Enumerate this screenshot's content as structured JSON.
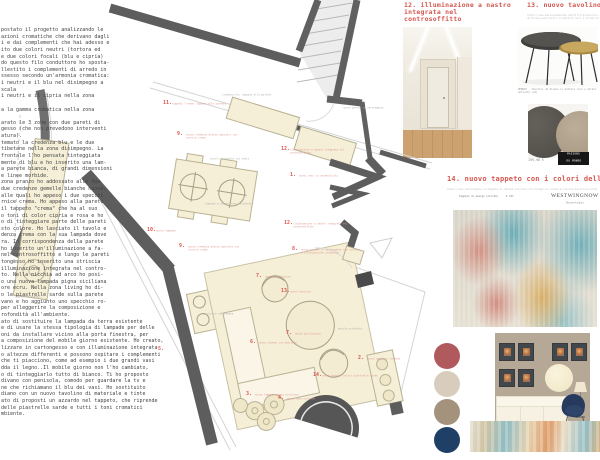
{
  "left_text": {
    "lines": [
      "postato il progetto analizzando le",
      "azioni cromatiche che derivano dagli",
      "i e dai complementi che hai adesso e",
      "ito due colori neutri (tortora ed",
      "e due colori focali (blu e cipria)",
      "do questo filo conduttore ho sposta-",
      "llestito i complementi di arredo in",
      "ssesso secondo un'armonia cromatica:",
      "i neutri e il blu nel disimpegno a",
      "scala",
      "i neutri e il cipria nella zona",
      "",
      "a la gamma cromatica nella zona",
      "",
      "arato le 3 zone con due pareti di",
      "gesso (che non prevedono interventi",
      "atura).",
      "temato la credenza blu e le due",
      "tibetane nella zona disimpegno. La",
      "frontale l'ho pensata tinteggiata",
      "mente di blu e ho inserito una lam-",
      "a parete bianca, di grandi dimensioni",
      "e linee morbide.",
      "zona pranzo ho addossato alle due",
      "due credenze gemelle bianche nuove,",
      "alle quali ho appeso i due specchi",
      "rnice crema. Ho appeso alla parete",
      "il tappeto \"crema\" che ha al suo",
      "o toni di color cipria e rosa e ho",
      "o di tinteggiare parte delle pareti",
      "sto colore. Ho lasciato il tavolo e",
      "denza crema con la sua lampada dove",
      "ra. In corrispondenza della parete",
      "ho inserito un'illuminazione a fa-",
      "nel controsoffitto e lungo le pareti",
      "tongesso ho inserito una striscia",
      "illuminazione integrata nel contro-",
      "to. Nella nicchia ad arco ho posi-",
      "o una nuova lampada pigna siciliana",
      "ore ecru. Nella zona living ho di-",
      "o le piastrelle sarde sulla parete",
      "vano e ho aggiunto uno specchio ro-",
      "per alleggerire la composizione e",
      "rofondità all'ambiente.",
      "ato di sostituire la lampada da terra esistente",
      "e di usare la stessa tipologia di lampade per delle",
      "oni da installare vicino alla porta finestra, per",
      "a composizione del mobile giorno esistente. Ho creato,",
      "lizzare in cartongesso e con illuminazione integrata",
      "o altezze differenti e possono ospitare i complementi",
      "che ti piacciono, come ad esempio i due grandi vasi",
      "dda il legno..Il mobile giorno non l'ho cambiato,",
      "o di tinteggiarlo tutto di bianco. Ti ho proposto",
      "divano con penisola, comodo per guardare la tv e",
      "ne che richiamano il blu dei vasi. Ho sostituito",
      "diano con un nuovo tavolino di materiale e tinte",
      "ato di proposti un azzardo nel tappeto, che riprende",
      "delle piastrelle sarde e tutti i toni cromatici",
      "mbiente."
    ]
  },
  "plan": {
    "labels": [
      {
        "num": "11.",
        "text": "tappeto \"crema\" (appeso alla parete)",
        "x": 163,
        "y": 100
      },
      {
        "num": "9.",
        "text": "nuova credenza bianca specchio con cornice crema",
        "x": 177,
        "y": 131
      },
      {
        "num": "12.",
        "text": "illuminazione a nastro integrata nel controsoffitto",
        "x": 281,
        "y": 146
      },
      {
        "num": "1.",
        "text": "nuovi vasi in ceramica blu",
        "x": 290,
        "y": 172
      },
      {
        "num": "10.",
        "text": "nuova lampada",
        "x": 147,
        "y": 227
      },
      {
        "num": "9.",
        "text": "nuova credenza bianca specchio con cornice crema",
        "x": 179,
        "y": 243
      },
      {
        "num": "8.",
        "text": "nuova parete in cartongesso con nicchie e illuminazione integrata",
        "x": 292,
        "y": 246
      },
      {
        "num": "12.",
        "text": "illuminazione a nastro integrata nel controsoffitto",
        "x": 284,
        "y": 220
      },
      {
        "num": "7.",
        "text": "nuova poltroncina",
        "x": 256,
        "y": 273
      },
      {
        "num": "13.",
        "text": "nuovo tavolino",
        "x": 281,
        "y": 288
      },
      {
        "num": "7.",
        "text": "nuova poltroncina",
        "x": 286,
        "y": 330
      },
      {
        "num": "6.",
        "text": "nuovo divano con penisola",
        "x": 250,
        "y": 339
      },
      {
        "num": "5.",
        "text": "",
        "x": 158,
        "y": 346
      },
      {
        "num": "2.",
        "text": "nuovo specchio rotondo",
        "x": 358,
        "y": 355
      },
      {
        "num": "3.",
        "text": "nuova lampada pigna siciliana",
        "x": 246,
        "y": 391
      },
      {
        "num": "4.",
        "text": "nuovi vasi colorati",
        "x": 278,
        "y": 395
      },
      {
        "num": "14.",
        "text": "nuovo tappeto colori piastrelle sarde",
        "x": 313,
        "y": 372
      }
    ],
    "notes": [
      {
        "text": "credenza blu (appesa alla parete)",
        "x": 222,
        "y": 94
      },
      {
        "text": "nuova parete in cartongesso",
        "x": 343,
        "y": 107
      },
      {
        "text": "tavolo esistente con sedie",
        "x": 210,
        "y": 158
      },
      {
        "text": "lampada a sospensione esistente",
        "x": 205,
        "y": 203
      },
      {
        "text": "nicchia attrezzata",
        "x": 206,
        "y": 313
      },
      {
        "text": "mobile esistente",
        "x": 338,
        "y": 328
      },
      {
        "text": "lampada esistente",
        "x": 14,
        "y": 296
      }
    ]
  },
  "products": {
    "lighting": {
      "heading": "12. illuminazione a nastro integrata nel controsoffitto"
    },
    "table": {
      "heading": "13. nuovo tavolino living",
      "url": "https://www.maisonsdumonde.com/IT/it/p/tavolini-da-divano-estraibili-in-metallo-nero-e-dorato.htm",
      "caption": "HENRIK - Tavolini da divano in metallo nero e dorato anticato (x2)",
      "price": "199,90 €",
      "brand_line1": "MAISONS",
      "brand_line2": "DU MONDE"
    },
    "rug": {
      "heading": "14. nuovo tappeto con i colori delle piastrelle sa",
      "url": "https://www.westwingnow.it/tappeto-di-design-colorato-con-frange-in-cotone-e-viscosa-tessitura-piatta.html",
      "name": "Tappeto di design colorato",
      "price": "€ 427",
      "store": "WESTWINGNOW",
      "store_sub": "Novantasei"
    }
  },
  "palette": {
    "swatches": [
      {
        "name": "rosso mattone",
        "hex": "#b05a5e"
      },
      {
        "name": "beige chiaro",
        "hex": "#d8cdbd"
      },
      {
        "name": "tortora",
        "hex": "#a4927c"
      },
      {
        "name": "blu navy",
        "hex": "#1f3f66"
      }
    ]
  },
  "colors": {
    "wall": "#5d5d5d",
    "cream_furniture": "#f5efd8",
    "label_red": "#e0544e",
    "heading_red": "#d4564f"
  }
}
